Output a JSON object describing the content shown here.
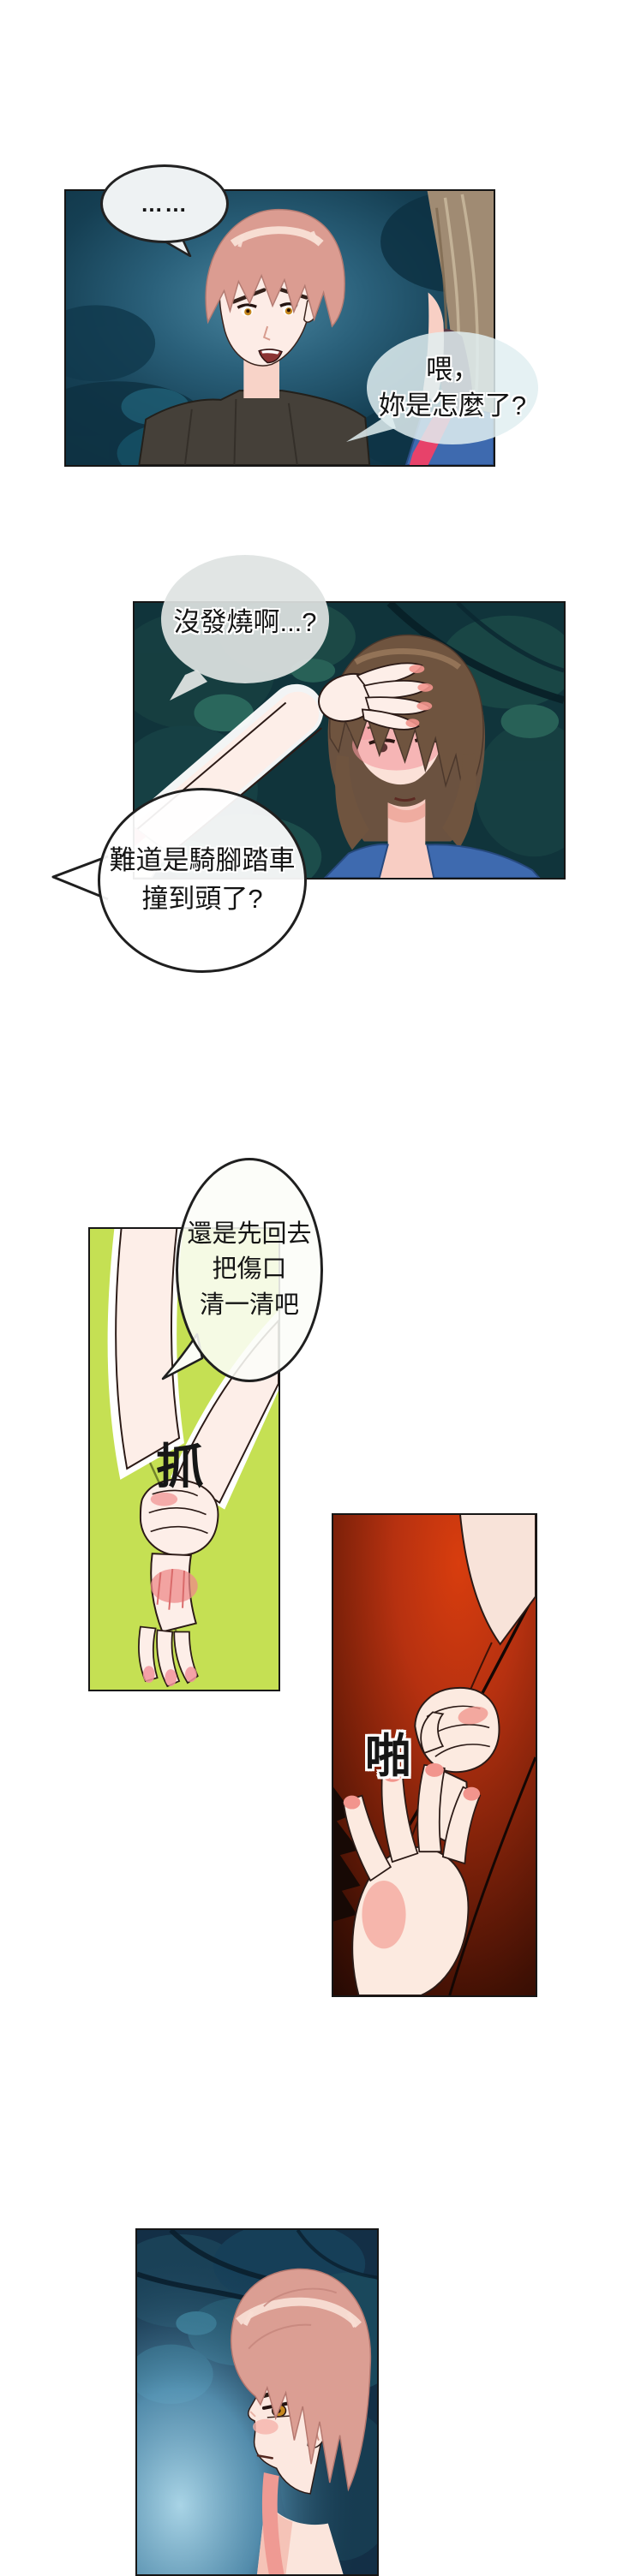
{
  "bubbles": {
    "ellipsis": {
      "text": "……"
    },
    "hey": {
      "lines": [
        "喂，",
        "妳是怎麼了?"
      ]
    },
    "fever": {
      "lines": [
        "沒發燒啊...?"
      ]
    },
    "bike": {
      "lines": [
        "難道是騎腳踏車",
        "撞到頭了?"
      ]
    },
    "goback": {
      "lines": [
        "還是先回去",
        "把傷口",
        "清一清吧"
      ]
    }
  },
  "sfx": {
    "grab": "抓",
    "slap": "啪"
  },
  "colors": {
    "page_background": "#ffffff",
    "panel1_night_teal": "#0f3c4c",
    "panel2_forest_teal": "#10343b",
    "panel3_green": "#c5e053",
    "panel4_red": "#d83d0e",
    "panel4_dark": "#1c0803",
    "panel5_navy": "#132f46",
    "skin": "#fdeee8",
    "salmon_hair": "#db9c91",
    "brown_hair": "#6f543f",
    "blue_top": "#3e6aaf",
    "red_strap": "#e7426a",
    "bubble_fill": "#eef2f3",
    "outline_black": "#1f1f1f",
    "blush_red": "#ee8a8a"
  }
}
